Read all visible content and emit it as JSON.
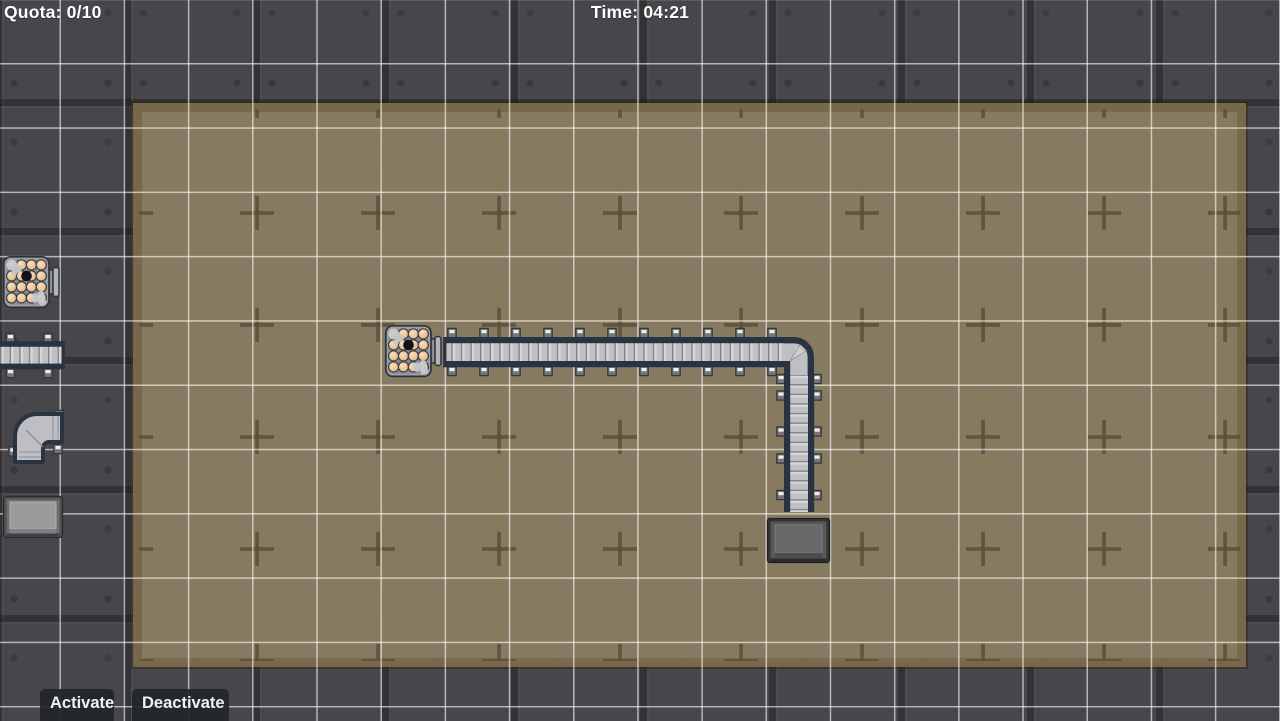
{
  "hud": {
    "quota": "Quota: 0/10",
    "time": "Time: 04:21"
  },
  "buttons": {
    "activate": "Activate",
    "deactivate": "Deactivate"
  },
  "palette": {
    "items": [
      {
        "id": "log-source",
        "icon": "log-bundle-icon"
      },
      {
        "id": "conveyor-straight",
        "icon": "conveyor-straight-icon"
      },
      {
        "id": "conveyor-corner",
        "icon": "conveyor-corner-icon"
      },
      {
        "id": "collection-bin",
        "icon": "bin-icon"
      }
    ]
  },
  "scene": {
    "machines": [
      {
        "type": "log-source",
        "x": 385,
        "y": 325
      },
      {
        "type": "conveyor-straight",
        "x": 445,
        "y": 337,
        "length": 343,
        "direction": "right"
      },
      {
        "type": "conveyor-corner",
        "x": 784,
        "y": 337,
        "turn": "right-to-down"
      },
      {
        "type": "conveyor-straight",
        "x": 784,
        "y": 367,
        "length": 145,
        "direction": "down"
      },
      {
        "type": "collection-bin",
        "x": 767,
        "y": 518
      }
    ]
  },
  "colors": {
    "metal_background": "#47474b",
    "floor": "#867b60",
    "floor_border": "#79674a",
    "floor_cross": "#5d4f37",
    "grid_line": "rgba(255,255,255,0.6)",
    "rail_navy": "#2a3342",
    "belt_gray": "#c1c1c5",
    "log_wood": "#eec397",
    "hud_text": "#ffffff",
    "button_bg": "#222529"
  }
}
